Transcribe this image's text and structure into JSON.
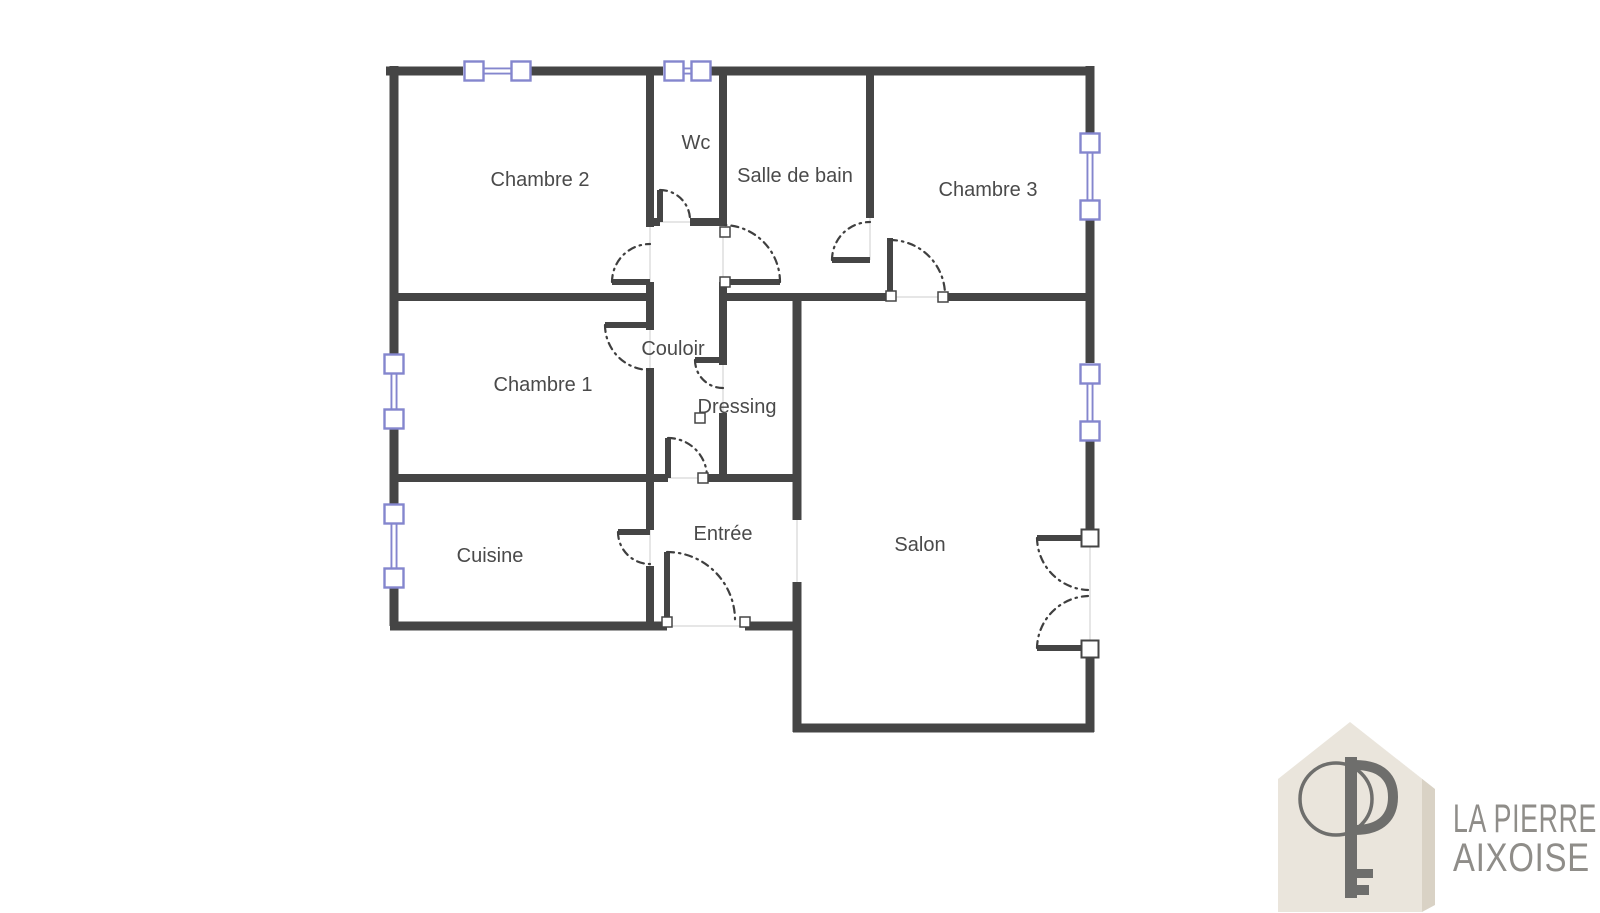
{
  "floorplan": {
    "rooms": [
      {
        "label": "Chambre 2"
      },
      {
        "label": "Wc"
      },
      {
        "label": "Salle de bain"
      },
      {
        "label": "Chambre 3"
      },
      {
        "label": "Chambre 1"
      },
      {
        "label": "Couloir"
      },
      {
        "label": "Dressing"
      },
      {
        "label": "Cuisine"
      },
      {
        "label": "Entrée"
      },
      {
        "label": "Salon"
      }
    ]
  },
  "branding": {
    "icon": "house-key-logo",
    "line1": "LA PIERRE",
    "line2": "AIXOISE"
  },
  "colors": {
    "background": "#ffffff",
    "wall": "#454545",
    "wall-core": "#9e9e9e",
    "door-arc": "#3f3f3f",
    "window-blue": "#8486ce",
    "threshold": "#d8d8d8",
    "label-text": "#4a4a4a",
    "logo-house": "#eae5dc",
    "logo-house-shadow": "#d9d2c5",
    "logo-key": "#6e6e6c",
    "brand-text": "#8f8d89"
  }
}
